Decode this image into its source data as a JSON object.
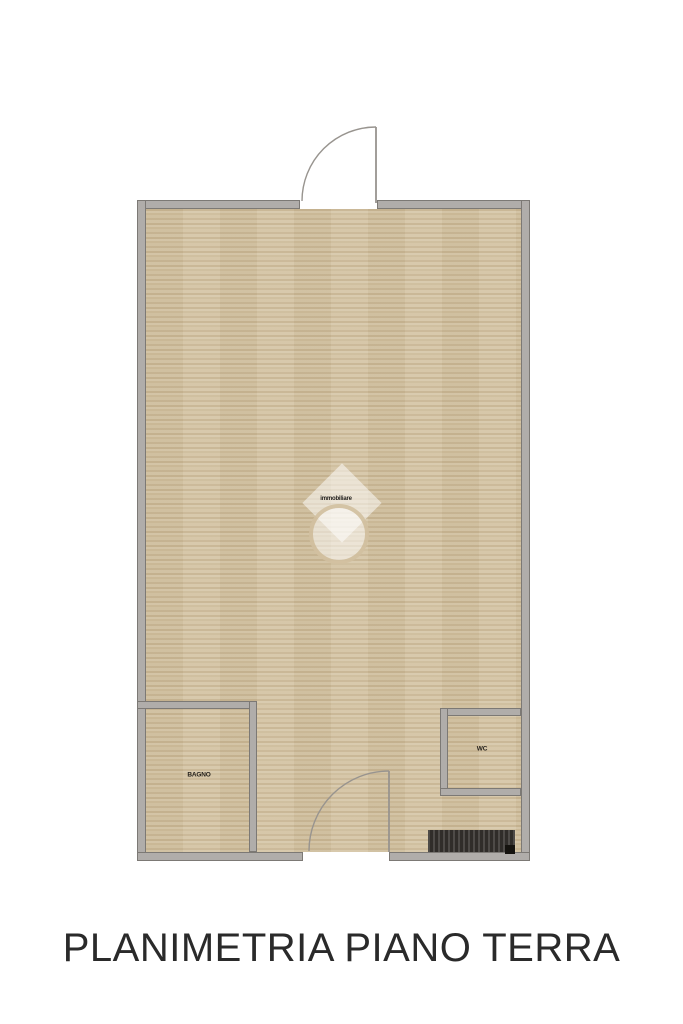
{
  "caption": {
    "text": "PLANIMETRIA PIANO TERRA"
  },
  "floor_plan": {
    "type": "residential ground-floor plan, top-down view",
    "watermark": {
      "logo": "diamond-over-circle house mark",
      "text": "immobiliare"
    },
    "rooms": [
      {
        "id": "main-room",
        "label": ""
      },
      {
        "id": "bottom-left-room",
        "label": "BAGNO"
      },
      {
        "id": "bottom-right-room",
        "label": "WC"
      }
    ],
    "doors": [
      {
        "id": "entrance-top",
        "swing": "outward, hinge right"
      },
      {
        "id": "interior-bottom",
        "swing": "inward, hinge right"
      }
    ],
    "fixtures": [
      {
        "id": "radiator",
        "position": "bottom-right against wall"
      }
    ]
  },
  "colors": {
    "background": "#ffffff",
    "wall_fill": "#b0adaa",
    "wall_outline": "#7c7975",
    "floor_base": "#d3c2a1",
    "door_line": "#98948f",
    "radiator": "#3a3733",
    "caption_text": "#2a2a2a",
    "watermark_white": "rgba(255,255,255,0.5)"
  }
}
